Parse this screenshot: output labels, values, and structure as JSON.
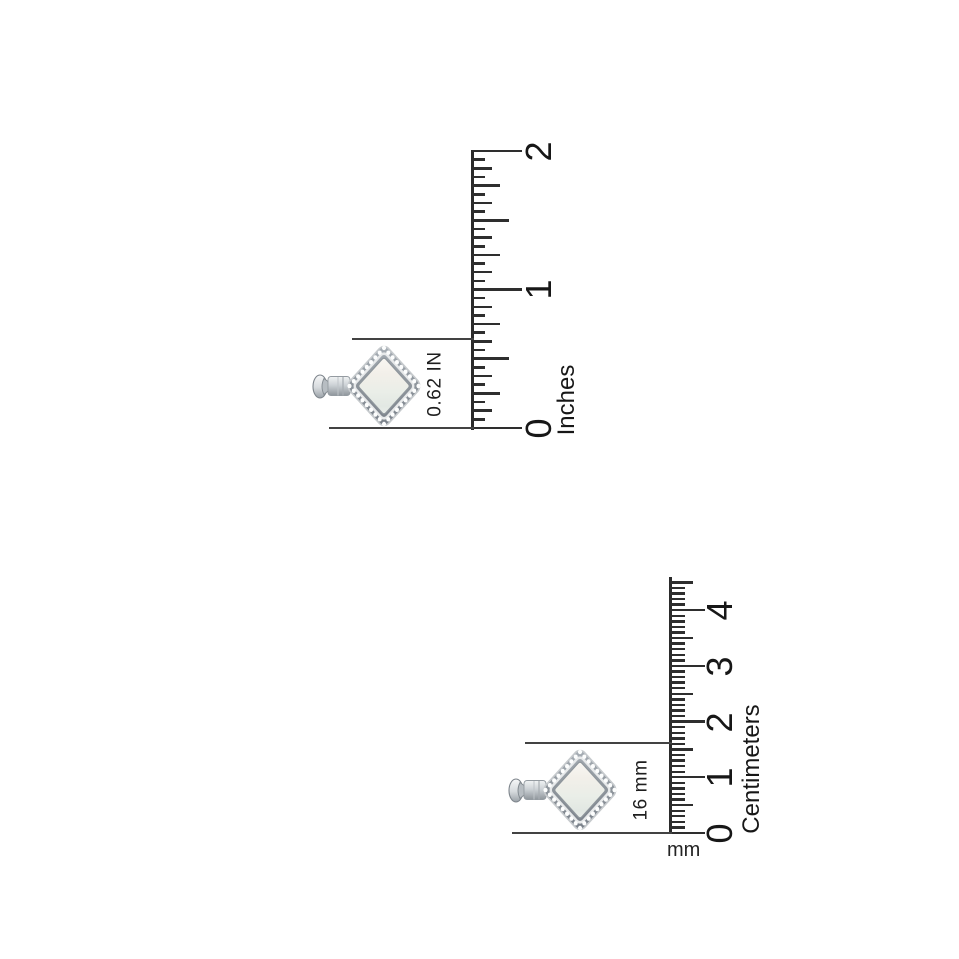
{
  "colors": {
    "background": "#ffffff",
    "ruler_line": "#2b2b2b",
    "tick": "#2e2e2e",
    "dimension_line": "#434343",
    "text": "#171717",
    "pendant_band": "#8d949b",
    "pendant_stone": "#eef0ea",
    "pendant_bead": "#fcfdfd"
  },
  "icons": {
    "pendant": "diamond-shaped-halo-pendant-with-bail",
    "inch_ruler": "vertical-inch-ruler",
    "cm_ruler": "vertical-centimeter-ruler"
  },
  "inch_ruler": {
    "unit_label": "Inches",
    "tick_labels": [
      "0",
      "1",
      "2"
    ],
    "whole_units": 2,
    "divisions_per_unit": 16,
    "measurement_label": "0.62 IN"
  },
  "cm_ruler": {
    "unit_label": "Centimeters",
    "sub_unit_label": "mm",
    "tick_labels": [
      "0",
      "1",
      "2",
      "3",
      "4"
    ],
    "whole_units": 4,
    "extra_minor_divisions": 5,
    "divisions_per_unit": 10,
    "measurement_label": "16 mm"
  }
}
